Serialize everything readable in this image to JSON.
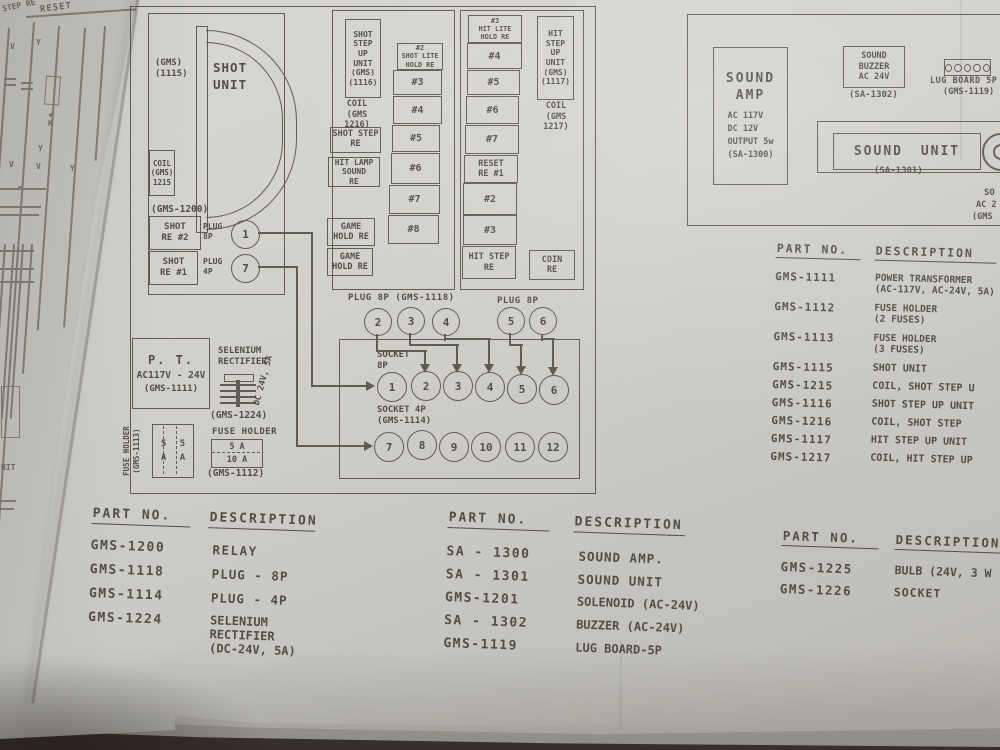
{
  "underlay": {
    "step_re": "STEP RE",
    "reset": "RESET",
    "v_top": "V",
    "y_top": "Y",
    "y_mid": "Y",
    "k": "K",
    "v_row": [
      "V",
      "V",
      "Y"
    ],
    "hit": "HIT"
  },
  "shot": {
    "group_part": "(GMS-1200)",
    "unit_part": "(GMS)\n(1115)",
    "unit_name": "SHOT\nUNIT",
    "coil": "COIL\n(GMS)\n1215",
    "relay2": "SHOT\nRE #2",
    "relay1": "SHOT\nRE #1",
    "plug8_label": "PLUG\n8P",
    "plug8_pin": "1",
    "plug4_label": "PLUG\n4P",
    "plug4_pin": "7"
  },
  "shot_step": {
    "unit": "SHOT\nSTEP\nUP\nUNIT\n(GMS)\n(1116)",
    "coil": "COIL\n(GMS\n1216)",
    "relay_shot_step": "SHOT STEP\nRE",
    "relay_hit_lamp": "HIT LAMP\nSOUND\nRE",
    "relay_game1": "GAME\nHOLD RE",
    "relay_game2": "GAME\nHOLD RE",
    "steps": [
      "#2\nSHOT LITE\nHOLD RE",
      "#3",
      "#4",
      "#5",
      "#6",
      "#7",
      "#8"
    ]
  },
  "hit": {
    "steps": [
      "#3\nHIT LITE\nHOLD RE",
      "#4",
      "#5",
      "#6",
      "#7",
      "RESET\nRE #1",
      "#2",
      "#3",
      "HIT STEP\nRE"
    ],
    "unit": "HIT\nSTEP\nUP\nUNIT\n(GMS)\n(1117)",
    "coil": "COIL\n(GMS\n1217)",
    "coin": "COIN\nRE"
  },
  "connector": {
    "plug_a_label": "PLUG 8P (GMS-1118)",
    "plug_a_pins": [
      "2",
      "3",
      "4"
    ],
    "plug_b_label": "PLUG 8P",
    "plug_b_pins": [
      "5",
      "6"
    ],
    "socket8_label": "SOCKET\n8P",
    "socket8_pins": [
      "1",
      "2",
      "3",
      "4",
      "5",
      "6"
    ],
    "socket4_label": "SOCKET 4P\n(GMS-1114)",
    "socket4_pins": [
      "7",
      "8",
      "9",
      "10",
      "11",
      "12"
    ]
  },
  "power": {
    "pt_title": "P. T.",
    "pt_rating": "AC117V - 24V",
    "pt_part": "(GMS-1111)",
    "selenium": "SELENIUM\nRECTIFIER",
    "selenium_rating": "DC 24V, 5A",
    "selenium_part": "(GMS-1224)",
    "fuse3_label": "FUSE HOLDER\n(GMS-1113)",
    "fuse3_values": "5 5\nA A",
    "fuse2_label": "FUSE HOLDER",
    "fuse2_top": "5 A",
    "fuse2_bottom": "10 A",
    "fuse2_part": "(GMS-1112)"
  },
  "sound": {
    "amp_title": "SOUND\nAMP",
    "amp_specs": "AC 117V\nDC 12V\nOUTPUT 5w\n(SA-1300)",
    "buzzer": "SOUND\nBUZZER\nAC 24V",
    "buzzer_part": "(SA-1302)",
    "lug_label": "LUG BOARD 5P",
    "lug_part": "(GMS-1119)",
    "unit_label": "SOUND UNIT",
    "unit_part": "(SA-1301)",
    "clipped": [
      "SO",
      "AC 2",
      "(GMS"
    ]
  },
  "list_main": {
    "col_part": "PART NO.",
    "col_desc": "DESCRIPTION",
    "rows": [
      {
        "part": "GMS-1111",
        "desc": "POWER TRANSFORMER\n(AC-117V, AC-24V, 5A)"
      },
      {
        "part": "GMS-1112",
        "desc": "FUSE HOLDER\n(2 FUSES)"
      },
      {
        "part": "GMS-1113",
        "desc": "FUSE HOLDER\n(3 FUSES)"
      },
      {
        "part": "GMS-1115",
        "desc": "SHOT UNIT"
      },
      {
        "part": "GMS-1215",
        "desc": "COIL, SHOT STEP U"
      },
      {
        "part": "GMS-1116",
        "desc": "SHOT STEP UP UNIT"
      },
      {
        "part": "GMS-1216",
        "desc": "COIL, SHOT STEP"
      },
      {
        "part": "GMS-1117",
        "desc": "HIT STEP UP UNIT"
      },
      {
        "part": "GMS-1217",
        "desc": "COIL, HIT STEP UP"
      }
    ]
  },
  "list_left": {
    "col_part": "PART NO.",
    "col_desc": "DESCRIPTION",
    "rows": [
      {
        "part": "GMS-1200",
        "desc": "RELAY"
      },
      {
        "part": "GMS-1118",
        "desc": "PLUG - 8P"
      },
      {
        "part": "GMS-1114",
        "desc": "PLUG - 4P"
      },
      {
        "part": "GMS-1224",
        "desc": "SELENIUM\nRECTIFIER\n(DC-24V, 5A)"
      }
    ]
  },
  "list_center": {
    "col_part": "PART NO.",
    "col_desc": "DESCRIPTION",
    "rows": [
      {
        "part": "SA - 1300",
        "desc": "SOUND AMP."
      },
      {
        "part": "SA - 1301",
        "desc": "SOUND UNIT"
      },
      {
        "part": "GMS-1201",
        "desc": "SOLENOID (AC-24V)"
      },
      {
        "part": "SA - 1302",
        "desc": "BUZZER (AC-24V)"
      },
      {
        "part": "GMS-1119",
        "desc": "LUG BOARD-5P"
      }
    ]
  },
  "list_right": {
    "col_part": "PART NO.",
    "col_desc": "DESCRIPTION",
    "rows": [
      {
        "part": "GMS-1225",
        "desc": "BULB (24V, 3 W"
      },
      {
        "part": "GMS-1226",
        "desc": "SOCKET"
      }
    ]
  },
  "colors": {
    "ink": "#514e46",
    "paper": "#d2d1cc",
    "surface": "#3a322a"
  }
}
